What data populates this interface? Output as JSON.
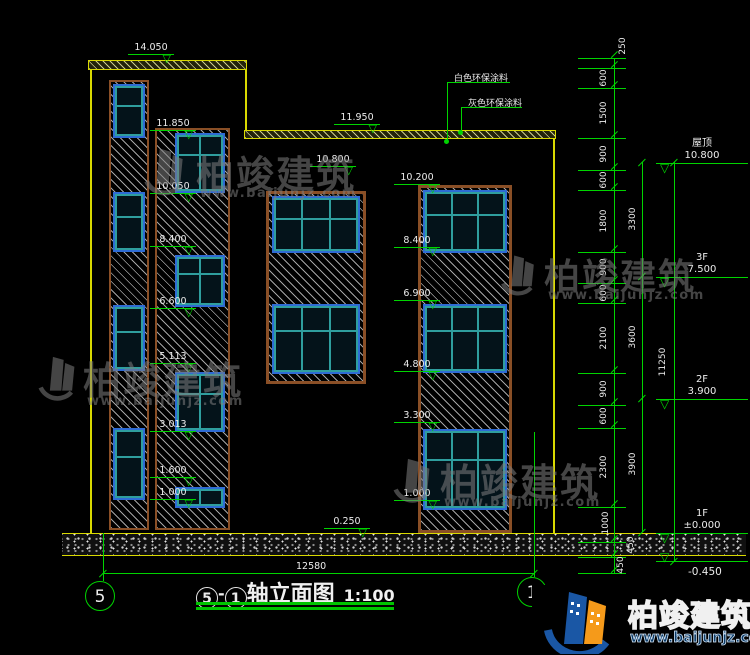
{
  "drawing": {
    "title": "轴立面图",
    "title_grid_start": "5",
    "title_grid_end": "1",
    "title_separator": "-",
    "scale": "1:100",
    "bottom_dimension": "12580",
    "grid_bubble_left": "5",
    "grid_bubble_right": "1"
  },
  "levels": {
    "roof_left": "14.050",
    "roof_right": "11.950",
    "center_top": "10.800",
    "plinth": "0.250",
    "left_strip": [
      "11.850",
      "10.050",
      "8.400",
      "6.600",
      "5.113",
      "3.013",
      "1.600",
      "1.000"
    ],
    "right_strip": [
      "10.200",
      "8.400",
      "6.900",
      "4.800",
      "3.300",
      "1.000"
    ]
  },
  "notes": {
    "white_paint": "白色环保涂料",
    "gray_paint": "灰色环保涂料"
  },
  "right_dims": {
    "segments": [
      "250",
      "600",
      "1500",
      "900",
      "600",
      "1800",
      "900",
      "600",
      "2100",
      "900",
      "600",
      "2300",
      "1000",
      "450",
      "450"
    ],
    "floor_spans": [
      "3300",
      "3600",
      "3900"
    ],
    "overall": "11250",
    "floors": [
      {
        "name": "屋顶",
        "elev": "10.800"
      },
      {
        "name": "3F",
        "elev": "7.500"
      },
      {
        "name": "2F",
        "elev": "3.900"
      },
      {
        "name": "1F",
        "elev": "±0.000"
      },
      {
        "name": "",
        "elev": "-0.450"
      }
    ]
  },
  "watermark": {
    "brand": "柏竣建筑",
    "site": "www.baijunjz.com"
  },
  "icons": {
    "level_triangle": "▽"
  },
  "colors": {
    "line_green": "#00d400",
    "line_yellow": "#d9d900",
    "frame_brown": "#8a4f26",
    "frame_blue": "#2e6bd4",
    "frame_teal": "#2f9e9e",
    "logo_blue": "#1a57a5",
    "logo_orange": "#f59a1a"
  }
}
